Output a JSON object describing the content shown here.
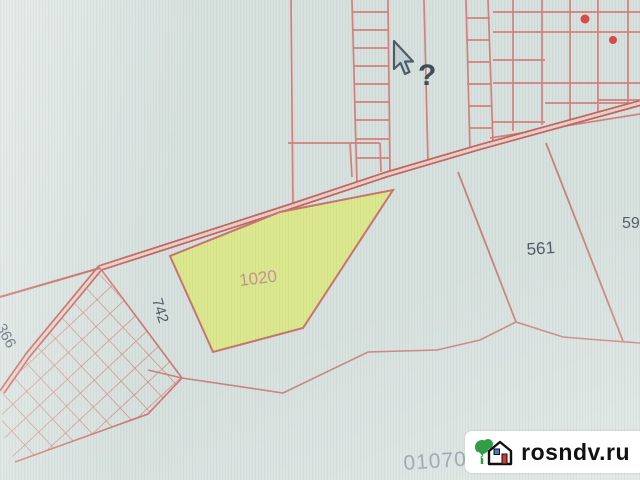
{
  "map": {
    "labels": {
      "p1020": "1020",
      "p561": "561",
      "p742": "742",
      "p366": "366",
      "p59": "59",
      "quarter_number": "0107005"
    },
    "colors": {
      "background": "#d7e1de",
      "parcel_line": "#d4827e",
      "road_line": "#c4665f",
      "road_inner": "#e8d0ca",
      "highlight_fill": "#dce88e",
      "highlight_border": "#c8766f",
      "building_marker": "#d94c48",
      "label_text": "#4e5a64",
      "highlight_label_text": "#c49792",
      "quarter_text": "#8e9aa6"
    }
  },
  "cursor": {
    "type": "help-arrow-cursor",
    "glyph": "?"
  },
  "watermark": {
    "text": "rosndv.ru"
  }
}
